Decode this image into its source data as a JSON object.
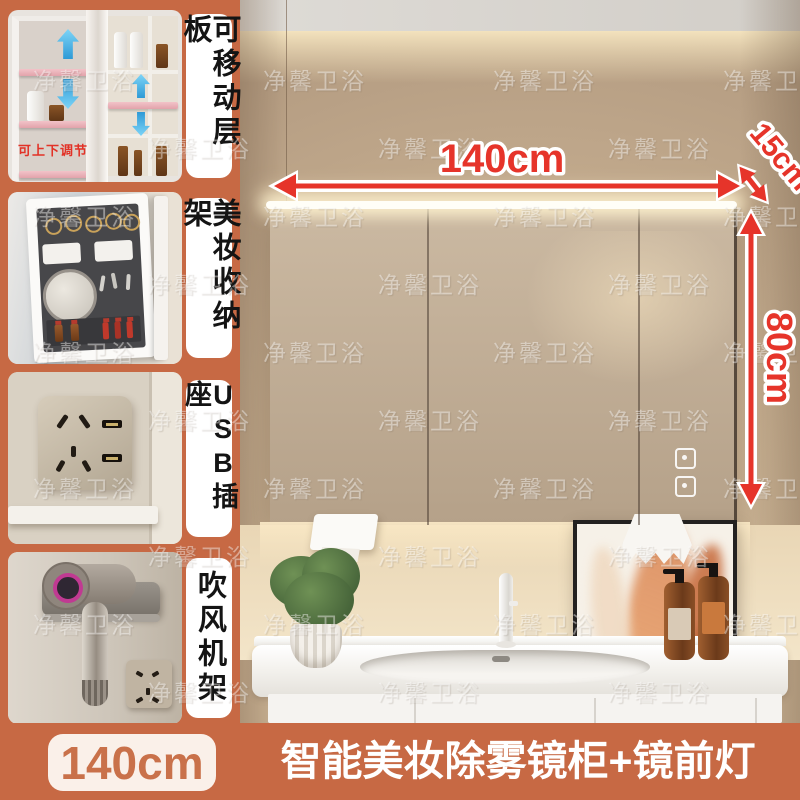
{
  "watermark": {
    "text": "净馨卫浴"
  },
  "sidebar": {
    "panels": [
      {
        "label": "可移动层板",
        "caption": "可上下调节"
      },
      {
        "label": "美妆收纳架"
      },
      {
        "label": "USB插座"
      },
      {
        "label": "吹风机架"
      }
    ]
  },
  "annotations": {
    "width": "140cm",
    "depth": "15cm",
    "height": "80cm"
  },
  "footer": {
    "size": "140cm",
    "title": "智能美妆除雾镜柜+镜前灯"
  },
  "colors": {
    "accent_orange": "#c76944",
    "dimension_red": "#e6342a",
    "badge_bg": "#faf0e9",
    "shelf_pink": "#edb6bc",
    "arrow_blue": "#2e9ad6"
  }
}
